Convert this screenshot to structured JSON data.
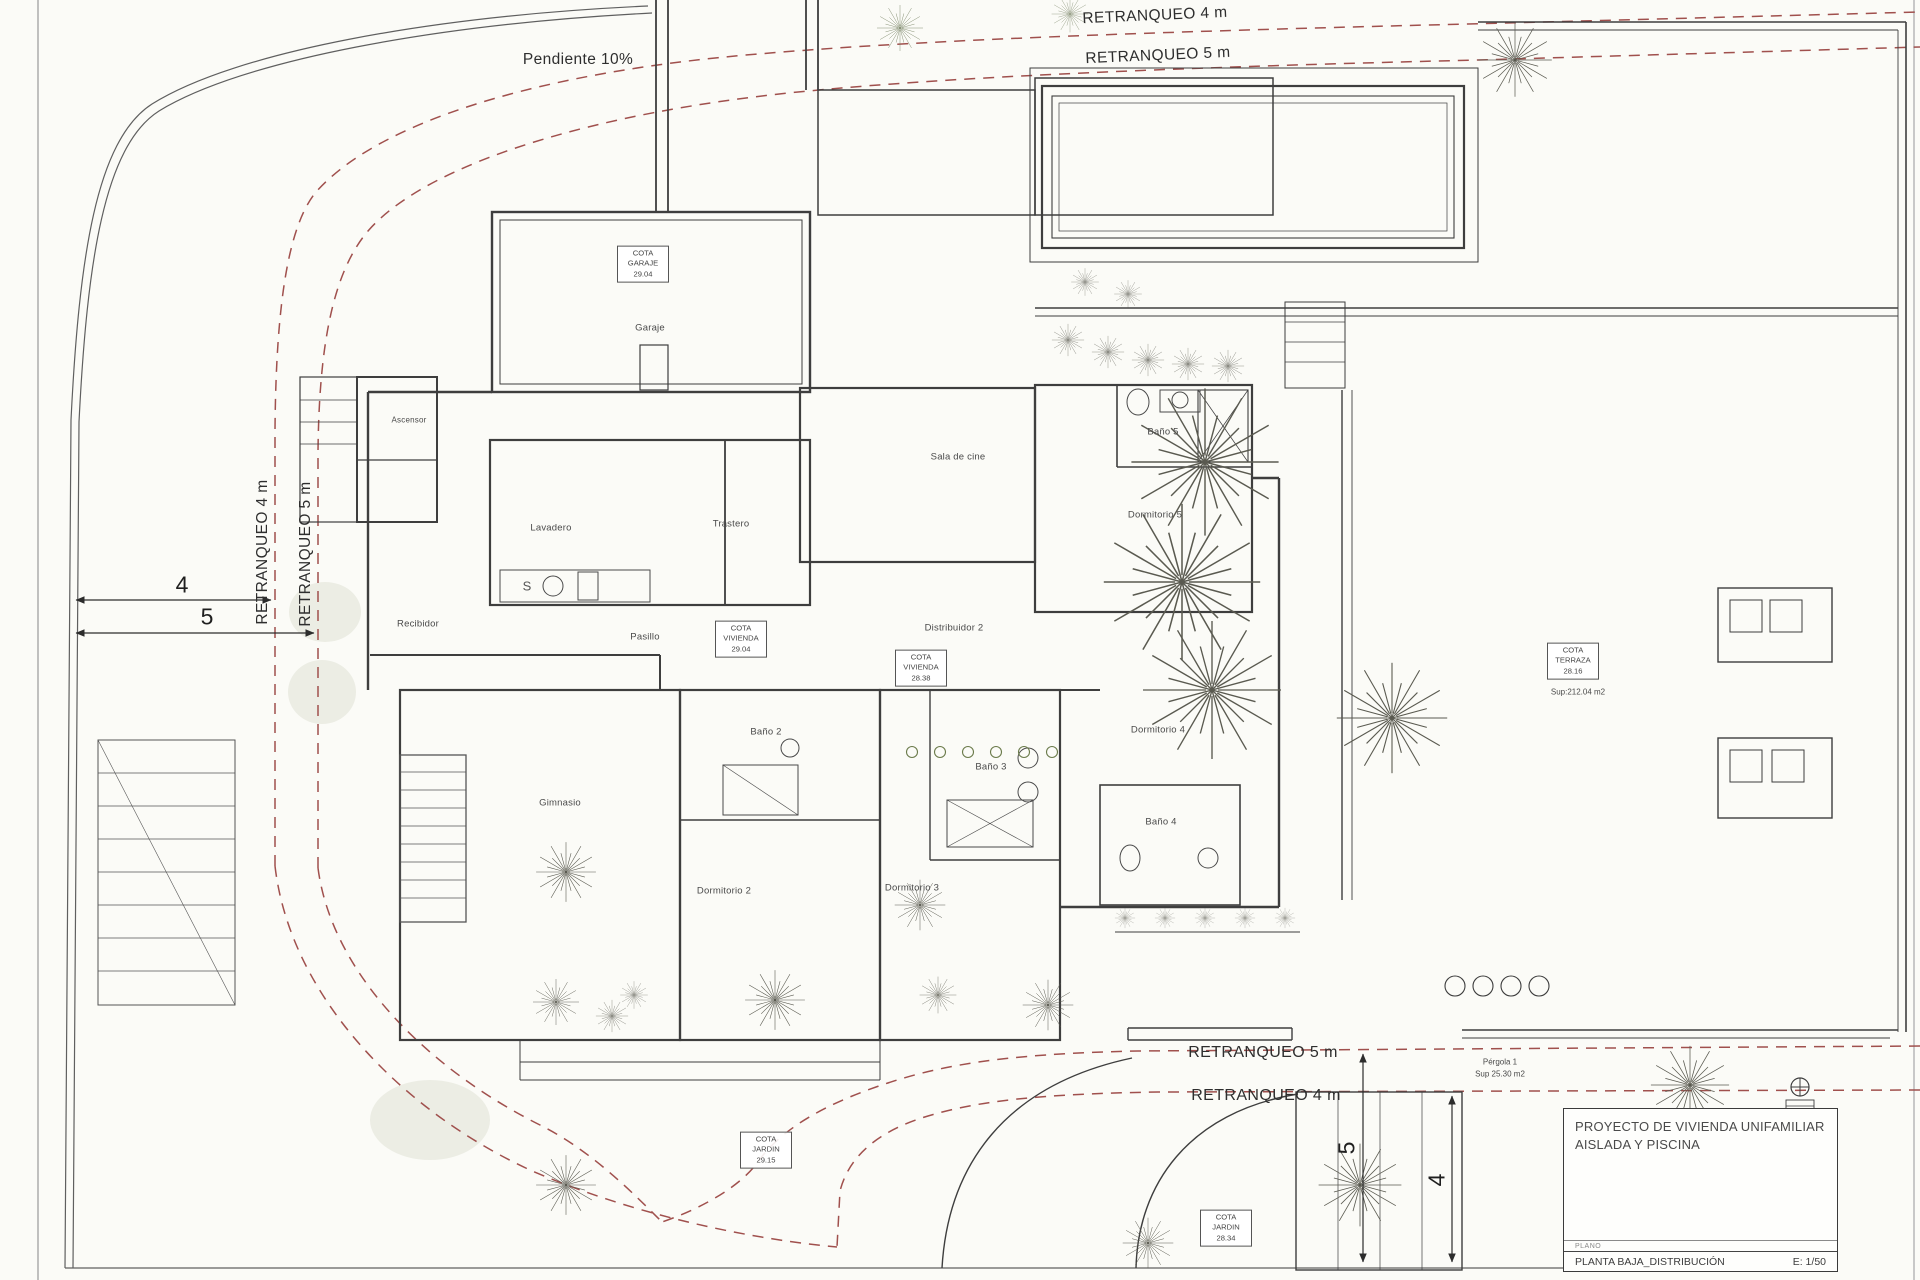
{
  "annotations": {
    "pendiente": "Pendiente 10%",
    "retranqueo_4m": "RETRANQUEO 4 m",
    "retranqueo_5m": "RETRANQUEO 5 m"
  },
  "dimensions": {
    "setback_4": "4",
    "setback_5": "5"
  },
  "rooms": [
    {
      "name": "Garaje"
    },
    {
      "name": "Ascensor"
    },
    {
      "name": "Lavadero"
    },
    {
      "name": "Trastero"
    },
    {
      "name": "Recibidor"
    },
    {
      "name": "Pasillo"
    },
    {
      "name": "Sala de cine"
    },
    {
      "name": "Baño 5"
    },
    {
      "name": "Dormitorio 5"
    },
    {
      "name": "Distribuidor 2"
    },
    {
      "name": "Dormitorio 4"
    },
    {
      "name": "Baño 4"
    },
    {
      "name": "Baño 3"
    },
    {
      "name": "Dormitorio 3"
    },
    {
      "name": "Dormitorio 2"
    },
    {
      "name": "Baño 2"
    },
    {
      "name": "Gimnasio"
    }
  ],
  "cotas": [
    {
      "line1": "COTA",
      "line2": "GARAJE",
      "line3": "29.04"
    },
    {
      "line1": "COTA",
      "line2": "VIVIENDA",
      "line3": "29.04"
    },
    {
      "line1": "COTA",
      "line2": "VIVIENDA",
      "line3": "28.38"
    },
    {
      "line1": "COTA",
      "line2": "TERRAZA",
      "line3": "28.16",
      "sup": "Sup:212.04 m2"
    },
    {
      "line1": "COTA",
      "line2": "JARDIN",
      "line3": "29.15"
    },
    {
      "line1": "COTA",
      "line2": "JARDIN",
      "line3": "28.34"
    }
  ],
  "pergola": {
    "name": "Pérgola 1",
    "sup": "Sup 25.30 m2"
  },
  "fixtures": {
    "sink_letter": "S"
  },
  "title_block": {
    "project_line1": "PROYECTO  DE VIVIENDA UNIFAMILIAR",
    "project_line2": "AISLADA Y PISCINA",
    "plano_label": "PLANO",
    "sheet_title": "PLANTA BAJA_DISTRIBUCIÓN",
    "scale": "E: 1/50"
  },
  "colors": {
    "setback_dashed": "#a0504d",
    "wall": "#3e3e3e",
    "paper": "#fbfbf7"
  }
}
